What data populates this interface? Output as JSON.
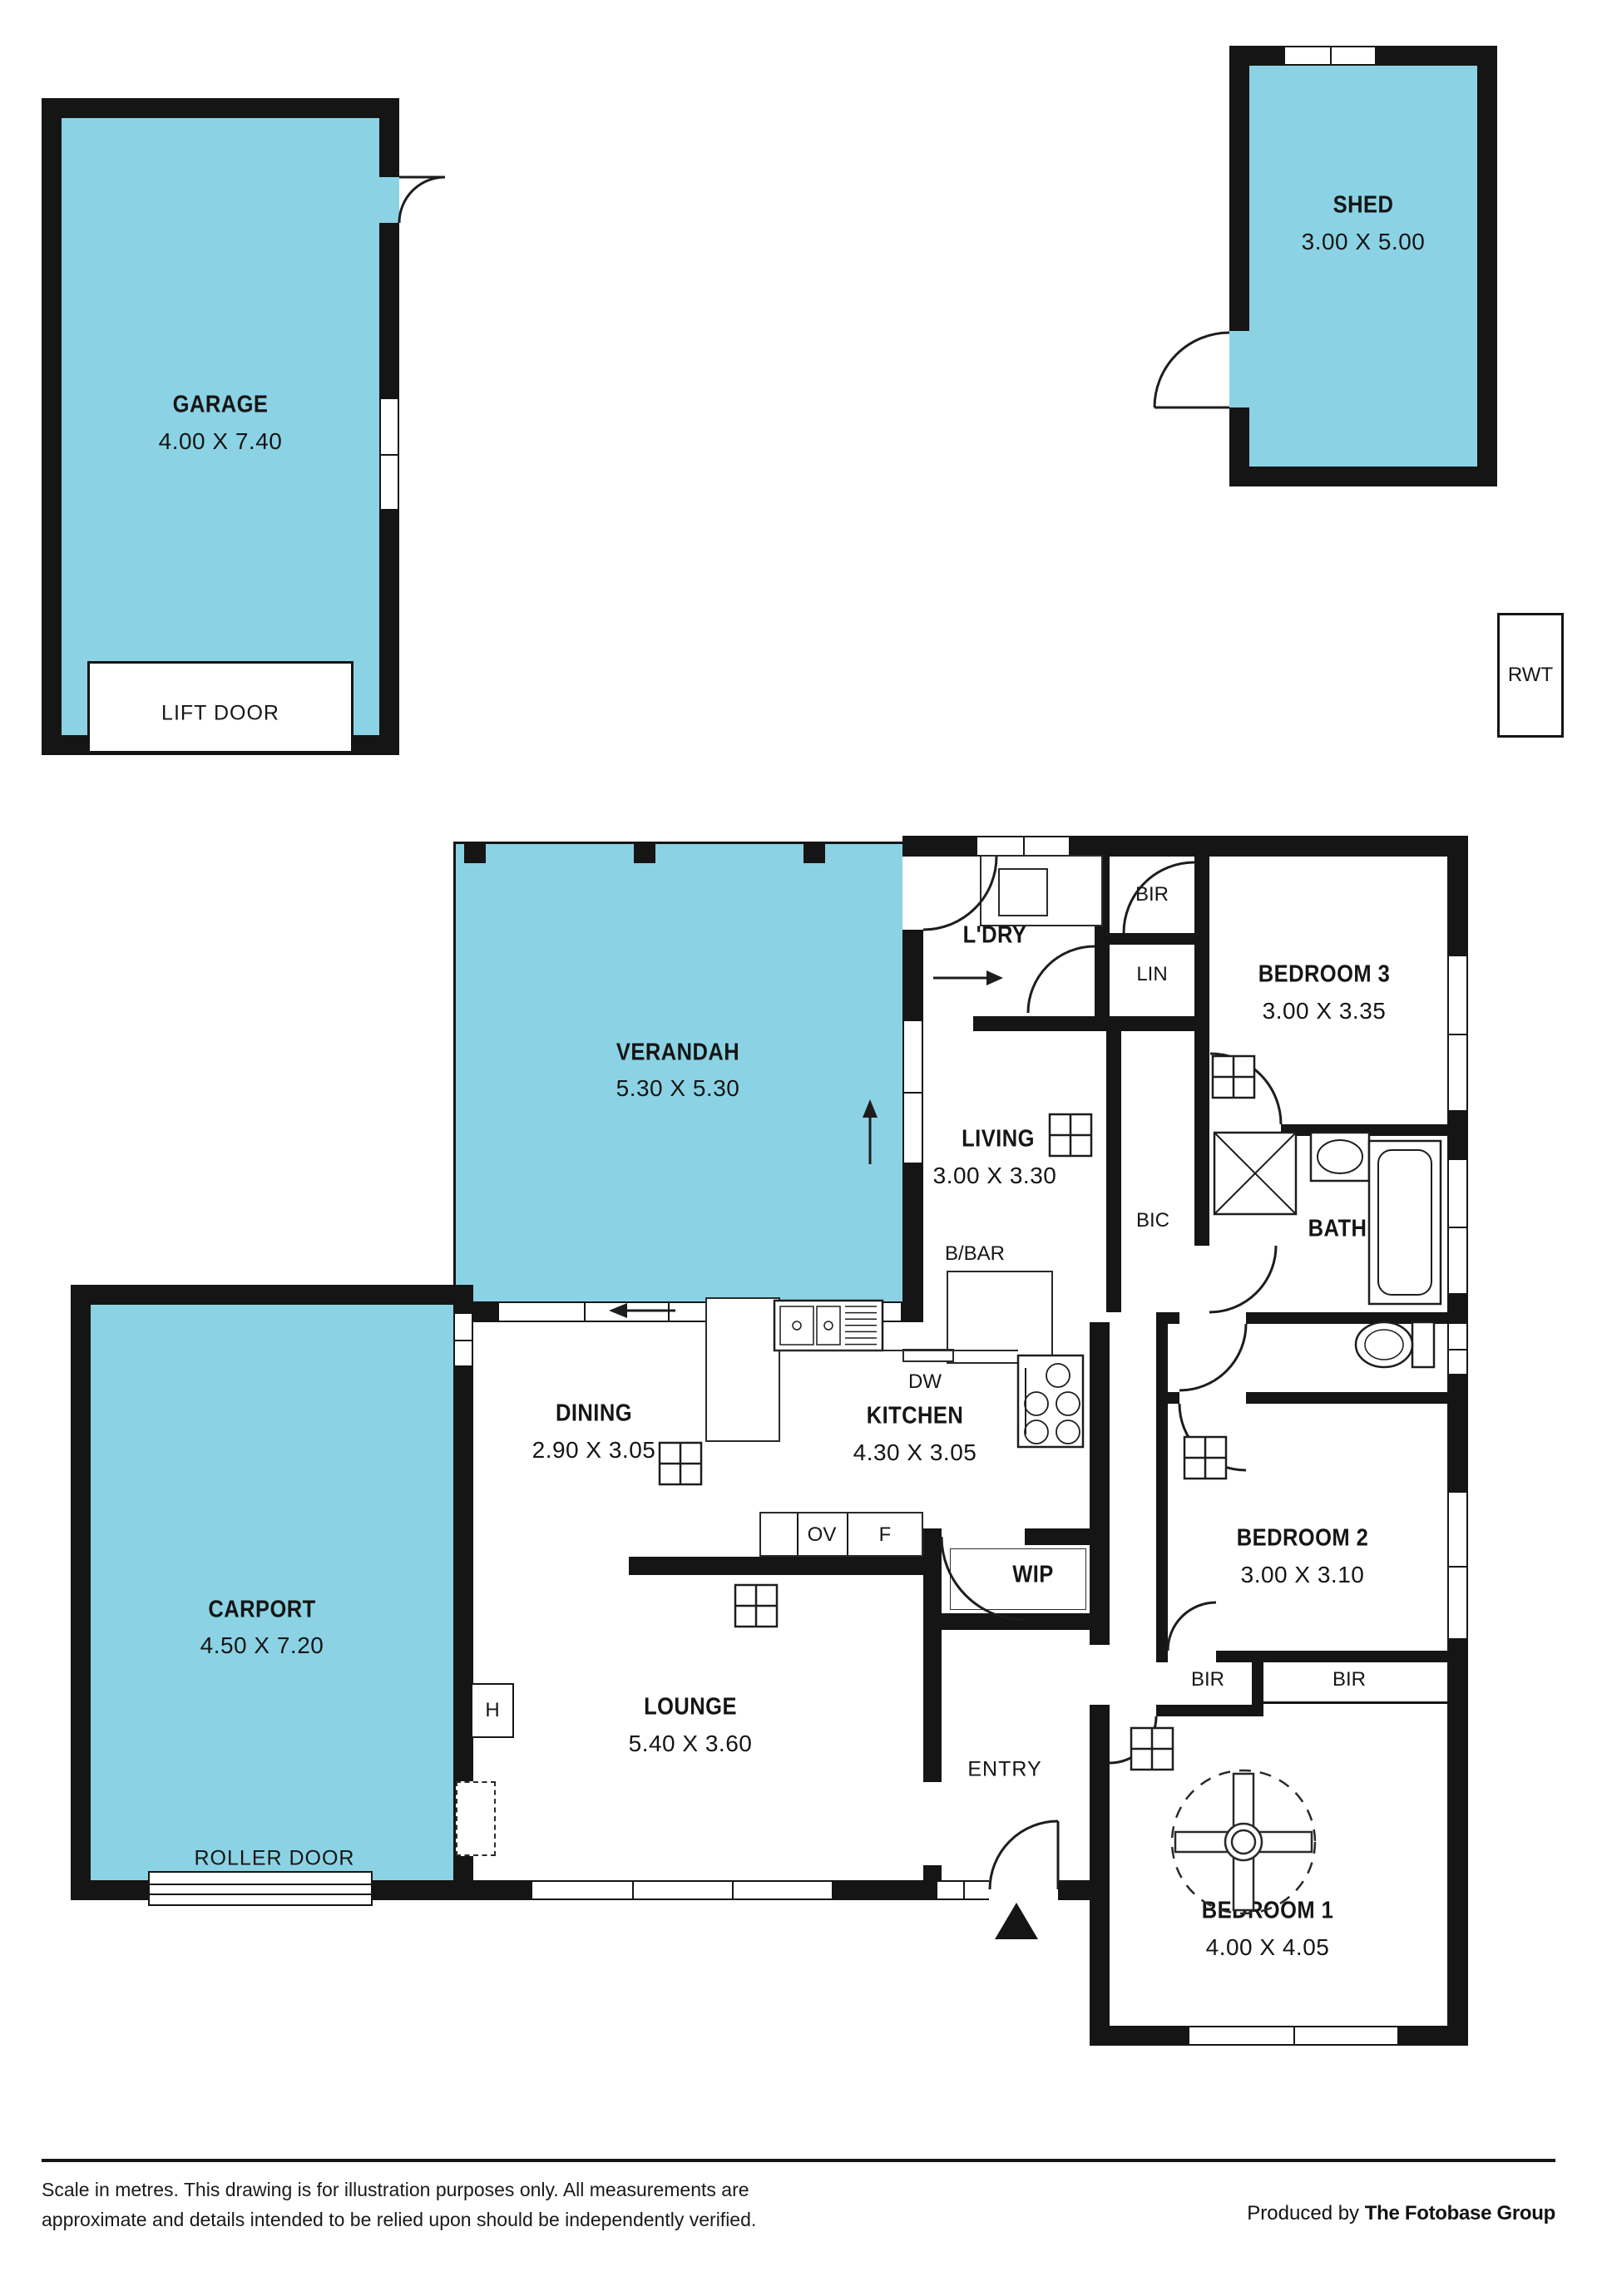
{
  "palette": {
    "outdoor_fill": "#8BD3E4",
    "wall": "#151515",
    "background": "#ffffff"
  },
  "outbuildings": {
    "garage": {
      "name": "GARAGE",
      "dims": "4.00 X 7.40",
      "door_label": "LIFT DOOR"
    },
    "shed": {
      "name": "SHED",
      "dims": "3.00 X 5.00"
    },
    "rwt": {
      "label": "RWT"
    }
  },
  "outdoor": {
    "verandah": {
      "name": "VERANDAH",
      "dims": "5.30 X 5.30"
    },
    "carport": {
      "name": "CARPORT",
      "dims": "4.50 X 7.20",
      "door_label": "ROLLER DOOR"
    }
  },
  "rooms": {
    "laundry": {
      "name": "L'DRY"
    },
    "bir_top": {
      "name": "BIR"
    },
    "linen": {
      "name": "LIN"
    },
    "bedroom3": {
      "name": "BEDROOM 3",
      "dims": "3.00 X 3.35"
    },
    "living": {
      "name": "LIVING",
      "dims": "3.00 X 3.30"
    },
    "bic": {
      "name": "BIC"
    },
    "bath": {
      "name": "BATH"
    },
    "bbar": {
      "name": "B/BAR"
    },
    "kitchen": {
      "name": "KITCHEN",
      "dims": "4.30 X 3.05",
      "dw": "DW",
      "ov": "OV",
      "fridge": "F"
    },
    "dining": {
      "name": "DINING",
      "dims": "2.90 X 3.05"
    },
    "wip": {
      "name": "WIP"
    },
    "lounge": {
      "name": "LOUNGE",
      "dims": "5.40 X 3.60",
      "heater": "H"
    },
    "entry": {
      "name": "ENTRY"
    },
    "bedroom2": {
      "name": "BEDROOM 2",
      "dims": "3.00 X 3.10"
    },
    "bir_left": {
      "name": "BIR"
    },
    "bir_right": {
      "name": "BIR"
    },
    "bedroom1": {
      "name": "BEDROOM 1",
      "dims": "4.00 X 4.05"
    }
  },
  "footer": {
    "disclaimer_line1": "Scale in metres. This drawing is for illustration purposes only. All measurements are",
    "disclaimer_line2": "approximate and details intended to be relied upon should be independently verified.",
    "credit_prefix": "Produced by ",
    "credit_brand": "The Fotobase Group"
  }
}
